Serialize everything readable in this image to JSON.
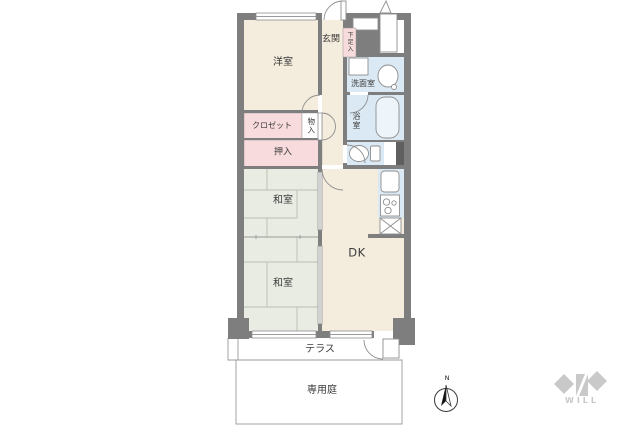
{
  "floorplan": {
    "labels": {
      "western_room": "洋室",
      "entrance": "玄関",
      "shoe_cabinet": "下足入",
      "washroom": "洗面室",
      "bathroom": "浴室",
      "closet": "クロゼット",
      "storage": "物入",
      "oshiire_closet": "押入",
      "japanese_room_upper": "和室",
      "japanese_room_lower": "和室",
      "dining_kitchen": "DK",
      "terrace": "テラス",
      "private_garden": "専用庭"
    },
    "fixture_icons": [
      "washing-machine-icon",
      "sink-icon",
      "bathtub-icon",
      "toilet-icon",
      "kitchen-sink-icon",
      "stove-icon",
      "refrigerator-icon",
      "meter-box-icon",
      "vent-roof-icon",
      "entrance-door-icon",
      "terrace-door-icon"
    ],
    "compass": {
      "north_label": "N"
    },
    "brand": {
      "logo_text": "WILL"
    }
  },
  "colors": {
    "wall": "#7e7e7e",
    "wall-dark": "#5f5f5f",
    "cream": "#f4ecdc",
    "pink": "#f8dbdc",
    "tatami": "#e9ece3",
    "water": "#dbe9f4",
    "tub": "#eef5fa",
    "line": "#8e8e8e",
    "tatami-line": "#b8bfb0",
    "thin": "#9a9a9a",
    "logo": "#c9c9c9",
    "text": "#3b3b3b"
  }
}
